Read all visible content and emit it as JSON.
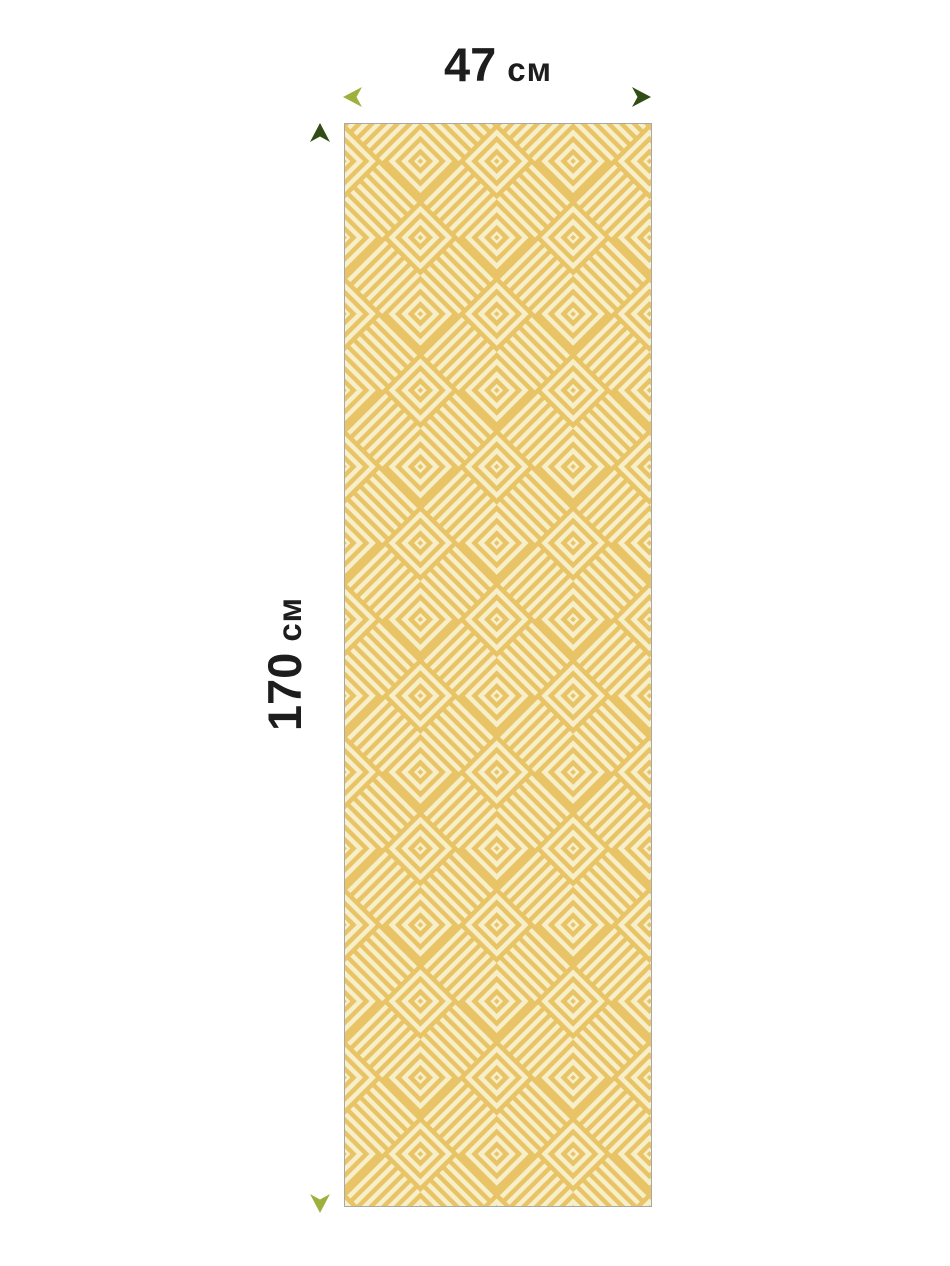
{
  "dimensions": {
    "width": {
      "value": "47",
      "unit": "см"
    },
    "height": {
      "value": "170",
      "unit": "см"
    }
  },
  "colors": {
    "background": "#ffffff",
    "label_text": "#1d1d1d",
    "arrow_light_green": "#9cb23c",
    "arrow_dark_green": "#2f4d15",
    "rug_yellow": "#e8c466",
    "rug_cream": "#f7efca",
    "rug_border": "#a8a8a8"
  },
  "icons": {
    "width_arrow": "double-headed horizontal measurement arrow",
    "height_arrow": "double-headed vertical measurement arrow"
  }
}
